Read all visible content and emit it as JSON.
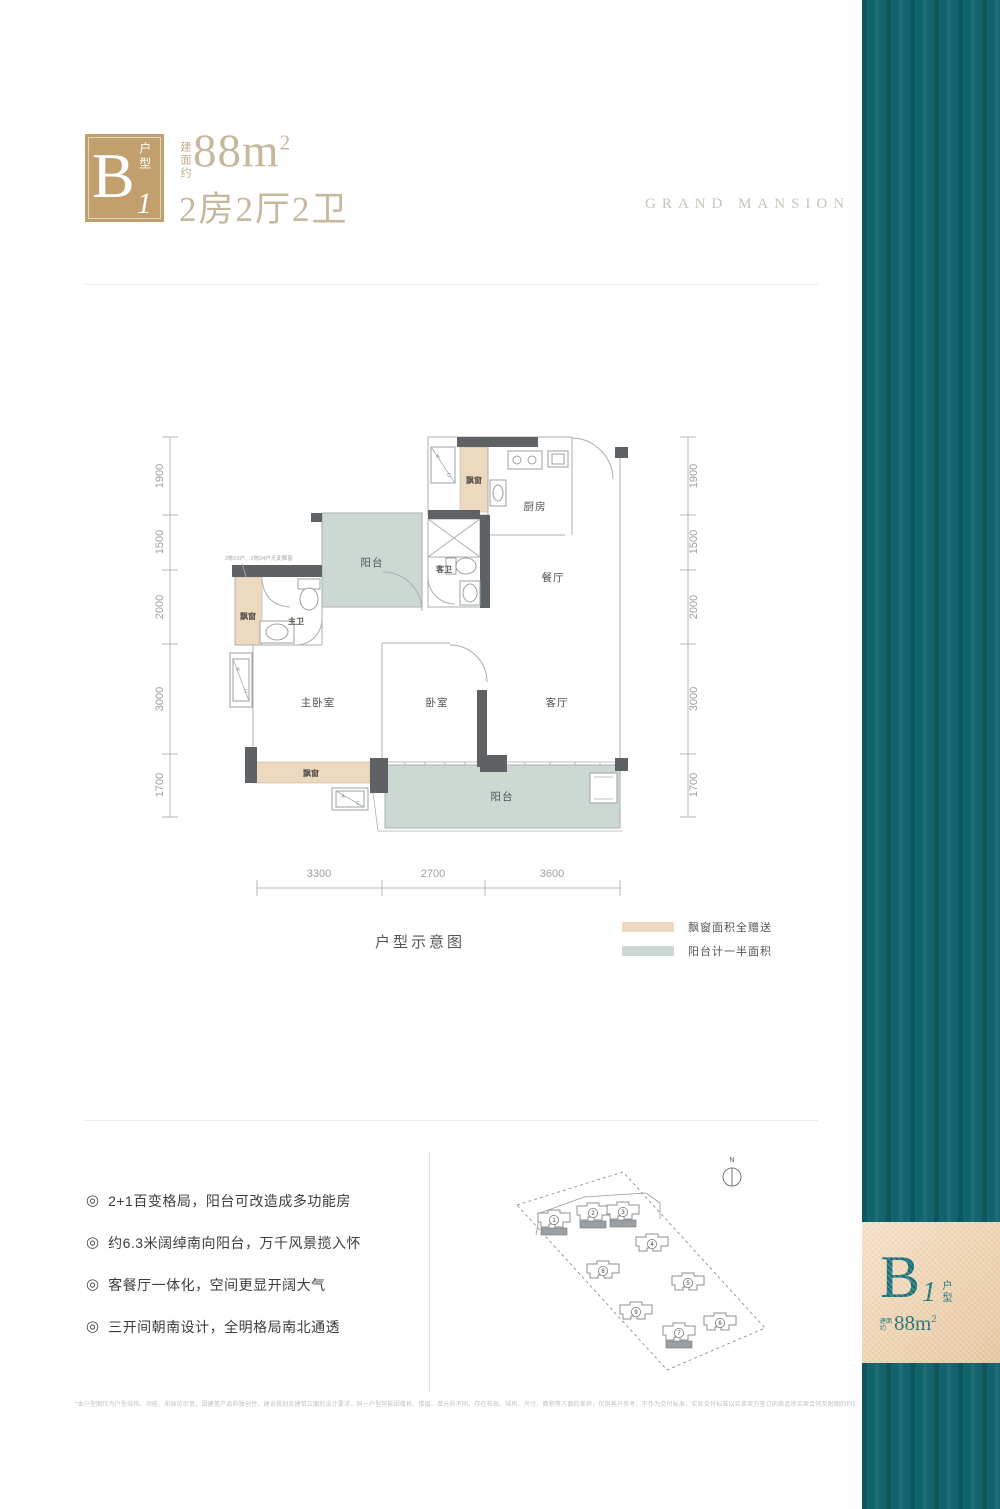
{
  "header": {
    "logo_letter": "B",
    "logo_number": "1",
    "logo_suffix": "户型",
    "area_prefix": "建面约",
    "area_value": "88m",
    "area_exp": "2",
    "layout_line": "2房2厅2卫",
    "brand": "GRAND MANSION"
  },
  "floorplan": {
    "caption": "户型示意图",
    "note": "2栋03户、2栋04户无此飘窗",
    "rooms": {
      "kitchen": "厨房",
      "dining": "餐厅",
      "living": "客厅",
      "bedroom": "卧室",
      "master_bedroom": "主卧室",
      "master_bath": "主卫",
      "guest_bath": "客卫",
      "balcony": "阳台",
      "bay_window": "飘窗"
    },
    "ac": {
      "a": "A",
      "c": "C"
    },
    "dims_left": [
      "1900",
      "1500",
      "2000",
      "3000",
      "1700"
    ],
    "dims_right": [
      "1900",
      "1500",
      "2000",
      "3000",
      "1700"
    ],
    "dims_bottom": [
      "3300",
      "2700",
      "3600"
    ]
  },
  "legend": {
    "items": [
      {
        "label": "飘窗面积全赠送",
        "color": "#ecd9bf"
      },
      {
        "label": "阳台计一半面积",
        "color": "#ccd9d3"
      }
    ]
  },
  "features": {
    "bullet": "◎",
    "items": [
      "2+1百变格局，阳台可改造成多功能房",
      "约6.3米阔绰南向阳台，万千风景揽入怀",
      "客餐厅一体化，空间更显开阔大气",
      "三开间朝南设计，全明格局南北通透"
    ]
  },
  "siteplan": {
    "north_label": "N",
    "buildings": [
      {
        "num": "1",
        "highlight": true
      },
      {
        "num": "2",
        "highlight": true
      },
      {
        "num": "3",
        "highlight": true
      },
      {
        "num": "4",
        "highlight": false
      },
      {
        "num": "8",
        "highlight": false
      },
      {
        "num": "5",
        "highlight": false
      },
      {
        "num": "9",
        "highlight": false
      },
      {
        "num": "7",
        "highlight": true
      },
      {
        "num": "6",
        "highlight": false
      }
    ]
  },
  "badge": {
    "letter": "B",
    "number": "1",
    "suffix": "户型",
    "area_prefix": "建面约",
    "area_value": "88m",
    "area_exp": "2"
  },
  "disclaimer": "*本户型图仅为户型结构、功能、布局的示意。因建筑产品的独创性、建设规划及建筑立面的设计要求，同一户型可能因楼栋、楼层、单元的不同，存在布局、结构、尺寸、面积等方面的差异，仅供客户参考，不作为交付标准，实际交付标准以买卖双方签订的商品房买卖合同及附图的约定为准。",
  "colors": {
    "accent_gold": "#c2a06d",
    "accent_teal": "#12656e",
    "bay_fill": "#ecd9bf",
    "balcony_fill": "#ccd9d3"
  }
}
